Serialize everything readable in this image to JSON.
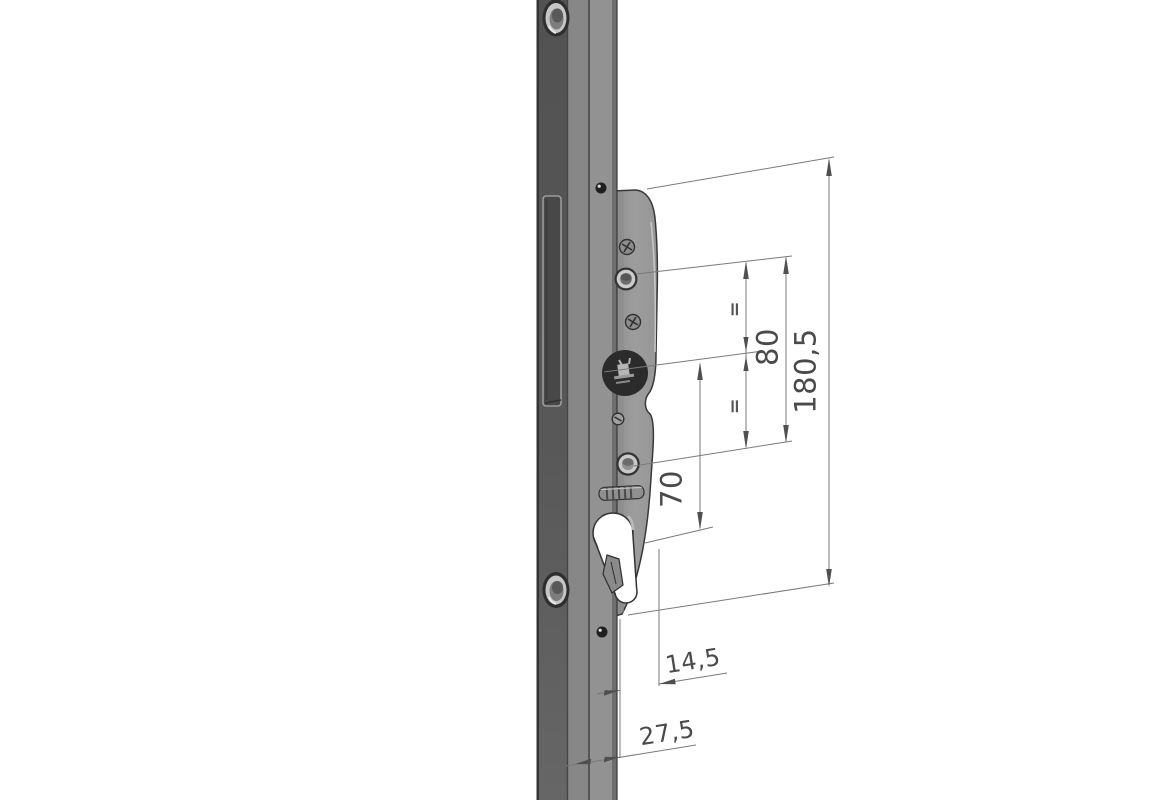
{
  "drawing": {
    "kind": "technical-drawing-isometric",
    "subject": "multipoint-door-lock-gearbox-with-faceplate",
    "background_color": "#ffffff",
    "dimension_line_color": "#7a7a7a",
    "dimension_text_color": "#4a4a4a",
    "part_dark_color": "#565656",
    "part_light_color": "#929292",
    "logo_badge_color": "#2b2b2b"
  },
  "dims": {
    "d180": {
      "label": "180,5"
    },
    "d80": {
      "label": "80"
    },
    "d70": {
      "label": "70"
    },
    "d14": {
      "label": "14,5"
    },
    "d27": {
      "label": "27,5"
    },
    "eq1": {
      "label": "="
    },
    "eq2": {
      "label": "="
    }
  }
}
